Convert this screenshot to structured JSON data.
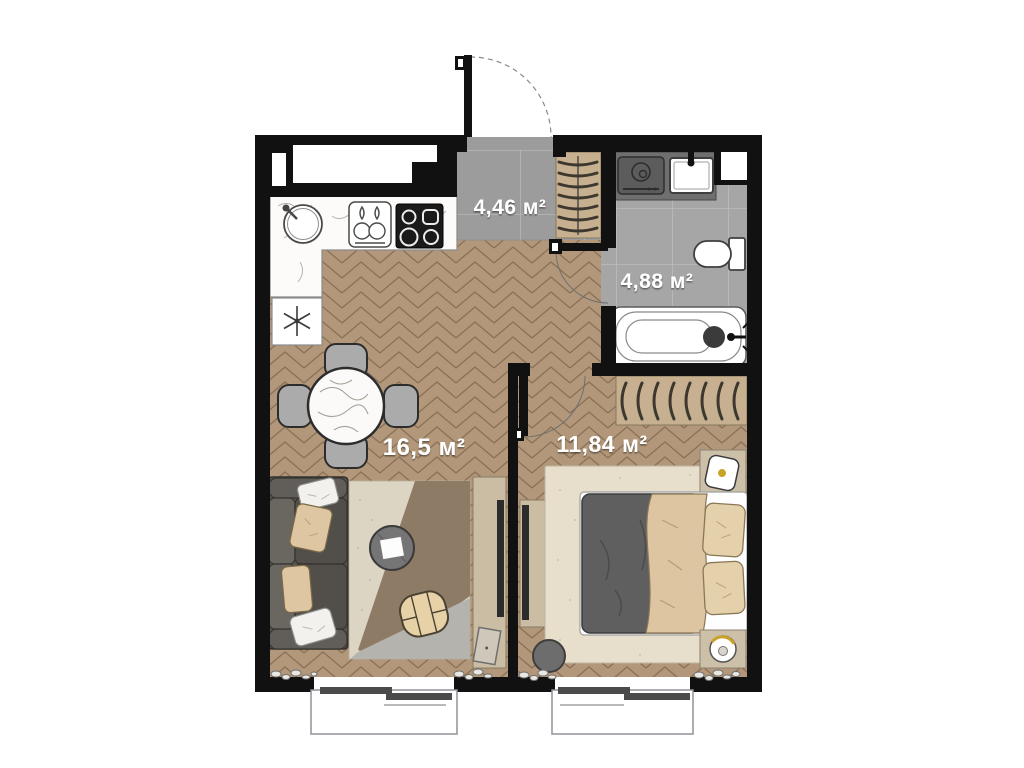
{
  "plan": {
    "type": "apartment floor plan",
    "units": "м²",
    "rooms": {
      "hall": {
        "name": "entry hall",
        "area_label": "4,46 м²",
        "area_m2": 4.46,
        "floor": "gray tile"
      },
      "bathroom": {
        "name": "bathroom",
        "area_label": "4,88 м²",
        "area_m2": 4.88,
        "floor": "gray tile"
      },
      "living": {
        "name": "kitchen-living room",
        "area_label": "16,5 м²",
        "area_m2": 16.5,
        "floor": "herringbone parquet"
      },
      "bedroom": {
        "name": "bedroom",
        "area_label": "11,84 м²",
        "area_m2": 11.84,
        "floor": "herringbone parquet"
      }
    },
    "furniture": {
      "kitchen": [
        "counter",
        "round-sink",
        "two-burner-hob",
        "induction-cooktop",
        "refrigerator"
      ],
      "living": [
        "dining-table",
        "chair x4",
        "sofa",
        "pillows",
        "rug",
        "coffee-table",
        "pouf",
        "tv-stand",
        "tv",
        "picture-frame"
      ],
      "hall": [
        "wardrobe-with-hangers",
        "entrance-door"
      ],
      "bathroom": [
        "washing-machine",
        "sink",
        "toilet",
        "bathtub",
        "shaft"
      ],
      "bedroom": [
        "double-bed",
        "duvet",
        "blanket",
        "pillow x2",
        "nightstand x2",
        "lamp x2",
        "wardrobe-with-hangers",
        "tv-stand",
        "tv",
        "stool",
        "rug"
      ]
    },
    "windows": 2,
    "doors": [
      "entrance",
      "bathroom",
      "bedroom"
    ],
    "colors": {
      "wall": "#111111",
      "parquet": "#b2977a",
      "parquet_line": "#8a7156",
      "hall_tile": "#9c9c9c",
      "bath_tile": "#a6a6a6",
      "tile_line": "#b8b8b8",
      "wood": "#c7b08f",
      "counter_dark": "#6f6f6f",
      "sofa": "#57534f",
      "textile": "#ddc5a0",
      "duvet": "#5f5f5f",
      "rug_cream": "#ddd5c3",
      "rug_brown": "#8d7b66",
      "rug_gray": "#b5b3ae",
      "bedroom_rug": "#e7dfcc",
      "gold": "#c9a227",
      "label_text": "#ffffff"
    }
  }
}
